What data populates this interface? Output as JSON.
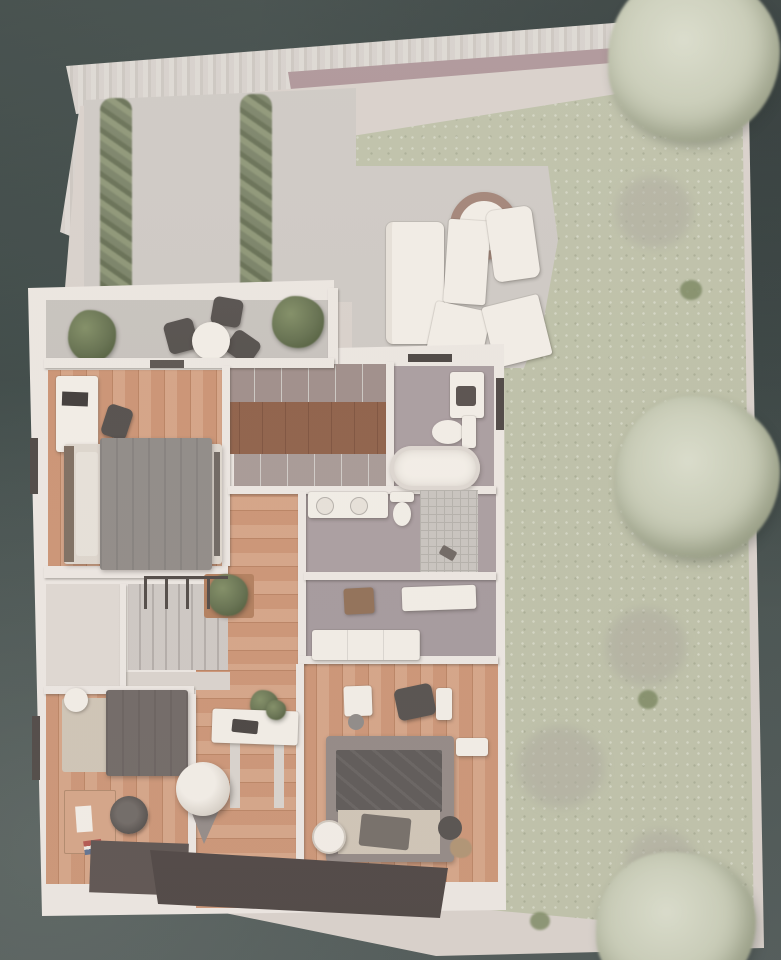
{
  "scene": {
    "description": "Photographed 3D architectural model: top-down floor plan of an apartment with roof terrace and walled garden",
    "view": "top-down",
    "visible_text": "none"
  },
  "colors": {
    "bg": "#3a4644",
    "fenceA": "#ddd8d3",
    "fenceB": "#cbc5bf",
    "fenceC": "#d6d0cb",
    "beam": "#aa9094",
    "path": "#d8d0ca",
    "paving": "#cdc8c3",
    "paving2": "#c6c1bc",
    "lawn": "#bcbfa6",
    "bushFaint": "#aaa79b",
    "shrub": "#77845c",
    "tree": "#c7cbb5",
    "treeHi": "#d9dcca",
    "treeDk": "#acb198",
    "wallW": "#ece6e1",
    "innerWall": "#f0eae5",
    "wood": "#ca9171",
    "woodDk": "#b87f5e",
    "woodLt": "#d4a183",
    "walnut": "#8c5c44",
    "walnutDk": "#7a4e39",
    "floorGray": "#a89b9e",
    "floorGray2": "#a2969a",
    "tile": "#c7c2bd",
    "tileLine": "#b3aea8",
    "stairA": "#cdc6c2",
    "stairB": "#b1aaa6",
    "rail": "#4b4440",
    "white": "#f2ede6",
    "whiteDim": "#e6e0d8",
    "darkFurn": "#4f4a47",
    "gray1": "#8d8884",
    "blanket2": "#575250",
    "beige": "#cec3b4",
    "rug": "#ddd5cc",
    "headboard": "#7a6a5c",
    "plant": "#5f6b49",
    "plantHi": "#7d8a60",
    "plantDk": "#44512f",
    "deck": "#4e4543",
    "teddy": "#ad8f6e",
    "storage": "#ded7d1",
    "wardrobe": "#9d8b87",
    "wardrobe2": "#a59793"
  },
  "garden": {
    "elements": [
      "slatted-fence",
      "fence-beam",
      "perimeter-path",
      "lawn",
      "paved-terrace"
    ],
    "hedges": 2,
    "trees": [
      "tree-top-right",
      "tree-mid-right",
      "tree-bottom-right"
    ],
    "bushes": 4,
    "shrub_dots": 4,
    "terrace_furniture": [
      "outdoor-sofa",
      "coffee-table",
      "outdoor-armchair",
      "sun-lounger-1",
      "sun-lounger-2",
      "fire-pit",
      "round-dining-table",
      "dining-chair-1",
      "dining-chair-2",
      "dining-chair-3",
      "planter-left",
      "planter-right"
    ]
  },
  "rooms": [
    {
      "id": "balcony-terrace",
      "floor": "concrete",
      "furniture": [
        "dining-set",
        "planters"
      ]
    },
    {
      "id": "master-bedroom",
      "floor": "oak",
      "furniture": [
        "wardrobe",
        "tv",
        "armchair",
        "double-bed"
      ]
    },
    {
      "id": "walk-in-closet",
      "floor": "walnut",
      "furniture": [
        "wardrobe-row-top",
        "wardrobe-row-bottom"
      ]
    },
    {
      "id": "bathroom",
      "floor": "stone",
      "furniture": [
        "vanity",
        "toilet",
        "bathtub"
      ]
    },
    {
      "id": "shower-room",
      "floor": "stone",
      "furniture": [
        "double-washbasin",
        "toilet",
        "walk-in-shower"
      ]
    },
    {
      "id": "utility-room",
      "floor": "stone",
      "furniture": [
        "counter",
        "sideboard",
        "side-table"
      ]
    },
    {
      "id": "hallway",
      "floor": "oak",
      "furniture": [
        "console-table",
        "laptop",
        "potted-plants",
        "hanging-chair"
      ]
    },
    {
      "id": "staircase",
      "furniture": [
        "railing"
      ]
    },
    {
      "id": "storage-room",
      "floor": "screed"
    },
    {
      "id": "kids-room",
      "floor": "oak",
      "furniture": [
        "single-bed",
        "desk",
        "office-chair",
        "floor-mat",
        "flag"
      ]
    },
    {
      "id": "bedroom-2",
      "floor": "oak",
      "furniture": [
        "vanity-desk",
        "stool",
        "armchair",
        "cabinet",
        "double-bed",
        "ottoman",
        "pouf",
        "teddy-bear",
        "nightstand"
      ]
    }
  ]
}
